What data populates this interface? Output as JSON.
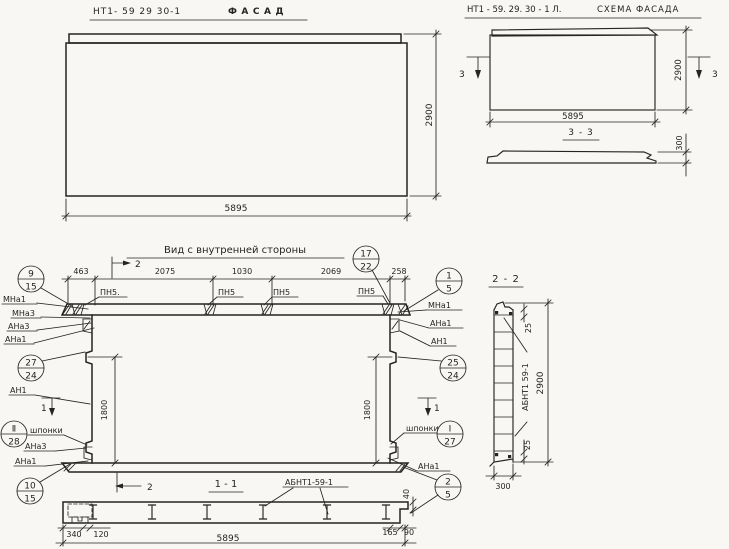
{
  "colors": {
    "ink": "#262420",
    "paper": "#f8f7f3"
  },
  "facade": {
    "part_number": "НТ1- 59  29  30-1",
    "title": "ФАСАД",
    "width": "5895",
    "height": "2900"
  },
  "schema": {
    "part_number": "НТ1 - 59. 29. 30 - 1 Л.",
    "title": "СХЕМА ФАСАДА",
    "cut_mark": "3",
    "width": "5895",
    "height": "2900",
    "section_title": "3 - 3",
    "thickness": "300"
  },
  "view": {
    "title": "Вид  с  внутренней  стороны",
    "top_dims": [
      "463",
      "2075",
      "1030",
      "2069",
      "258"
    ],
    "cut2": "2",
    "cut1": "1",
    "side_dim_left": "1800",
    "side_dim_right": "1800",
    "lip_dim": "40",
    "pn_labels": [
      "ПН5.",
      "ПН5",
      "ПН5",
      "ПН5"
    ],
    "keys_left": "шпонки",
    "keys_right": "шпонки",
    "marks_left_top": [
      "МНа1",
      "МНа3",
      "АНа3",
      "АНа1"
    ],
    "mark_left_mid": "АН1",
    "marks_left_bottom": [
      "АНа3",
      "АНа1"
    ],
    "marks_right_top": [
      "МНа1",
      "АНа1",
      "АН1"
    ],
    "mark_right_bottom": "АНа1",
    "callouts": {
      "c9_15": [
        "9",
        "15"
      ],
      "c27_24": [
        "27",
        "24"
      ],
      "c2_28": [
        "Ⅱ",
        "28"
      ],
      "c10_15": [
        "10",
        "15"
      ],
      "c17_22": [
        "17",
        "22"
      ],
      "c1_5": [
        "1",
        "5"
      ],
      "c25_24": [
        "25",
        "24"
      ],
      "c1_27": [
        "Ⅰ",
        "27"
      ],
      "c2_5": [
        "2",
        "5"
      ]
    }
  },
  "sec11": {
    "title": "1 - 1",
    "cut2": "2",
    "item": "АБНТ1-59-1",
    "d340": "340",
    "d120": "120",
    "d165": "165",
    "d90": "90",
    "total": "5895"
  },
  "sec22": {
    "title": "2 - 2",
    "item": "АБНТ1 59-1",
    "height": "2900",
    "width": "300",
    "edge_top": "25",
    "edge_bottom": "25"
  }
}
